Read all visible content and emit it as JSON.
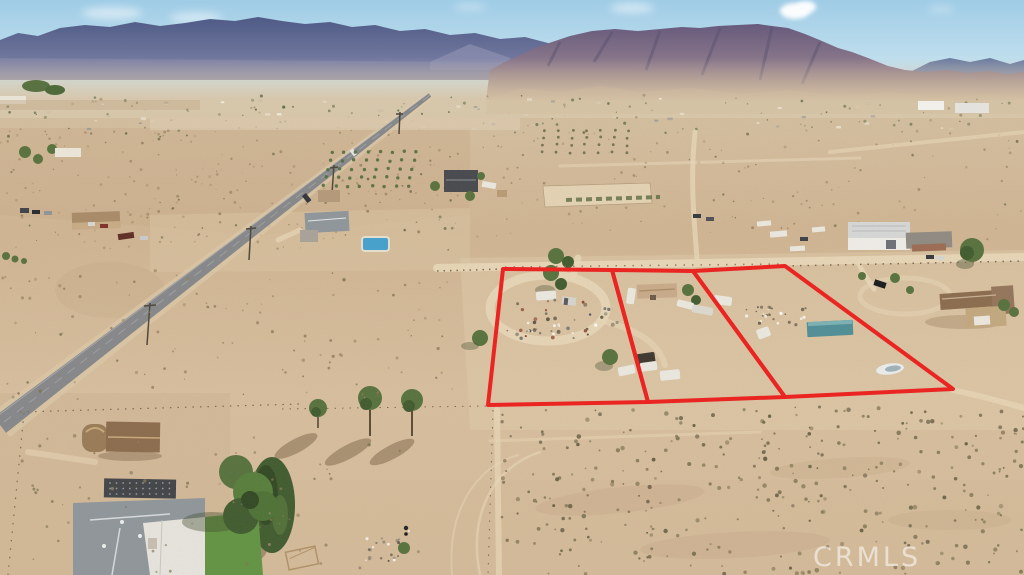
{
  "scene": {
    "title": "aerial-desert-property-photo",
    "description": "Drone aerial photo of high-desert land with three parcels outlined in red, mountains on the horizon and a paved road crossing the left side",
    "watermark": "CRMLS",
    "parcel_count": "3"
  },
  "colors": {
    "sky_top": "#9fcce6",
    "sky_horizon": "#e2eff3",
    "mountain_far": "#4e5b86",
    "mountain_far_base": "#8386aa",
    "mountain_near_top": "#675a7c",
    "mountain_near_base": "#a8918d",
    "ridge_right": "#9d95b0",
    "haze": "#d6c3a4",
    "ground": "#d2b996",
    "ground_bright": "#e3cfae",
    "ground_dark": "#c3a784",
    "road_asphalt": "#85878a",
    "dirt_path": "#ead9b9",
    "boundary_red": "#ee1d1b",
    "tree_green": "#55713c",
    "tree_dark": "#3e5a2d",
    "lawn_green": "#619341",
    "pool_blue": "#41a1cf",
    "container_teal": "#4d8e96",
    "roof_gray": "#8e969b",
    "roof_brown": "#8a6a4c",
    "roof_tan": "#c9ab89",
    "white_vehicle": "#eceae2",
    "watermark_white": "rgba(255,255,255,0.55)"
  }
}
